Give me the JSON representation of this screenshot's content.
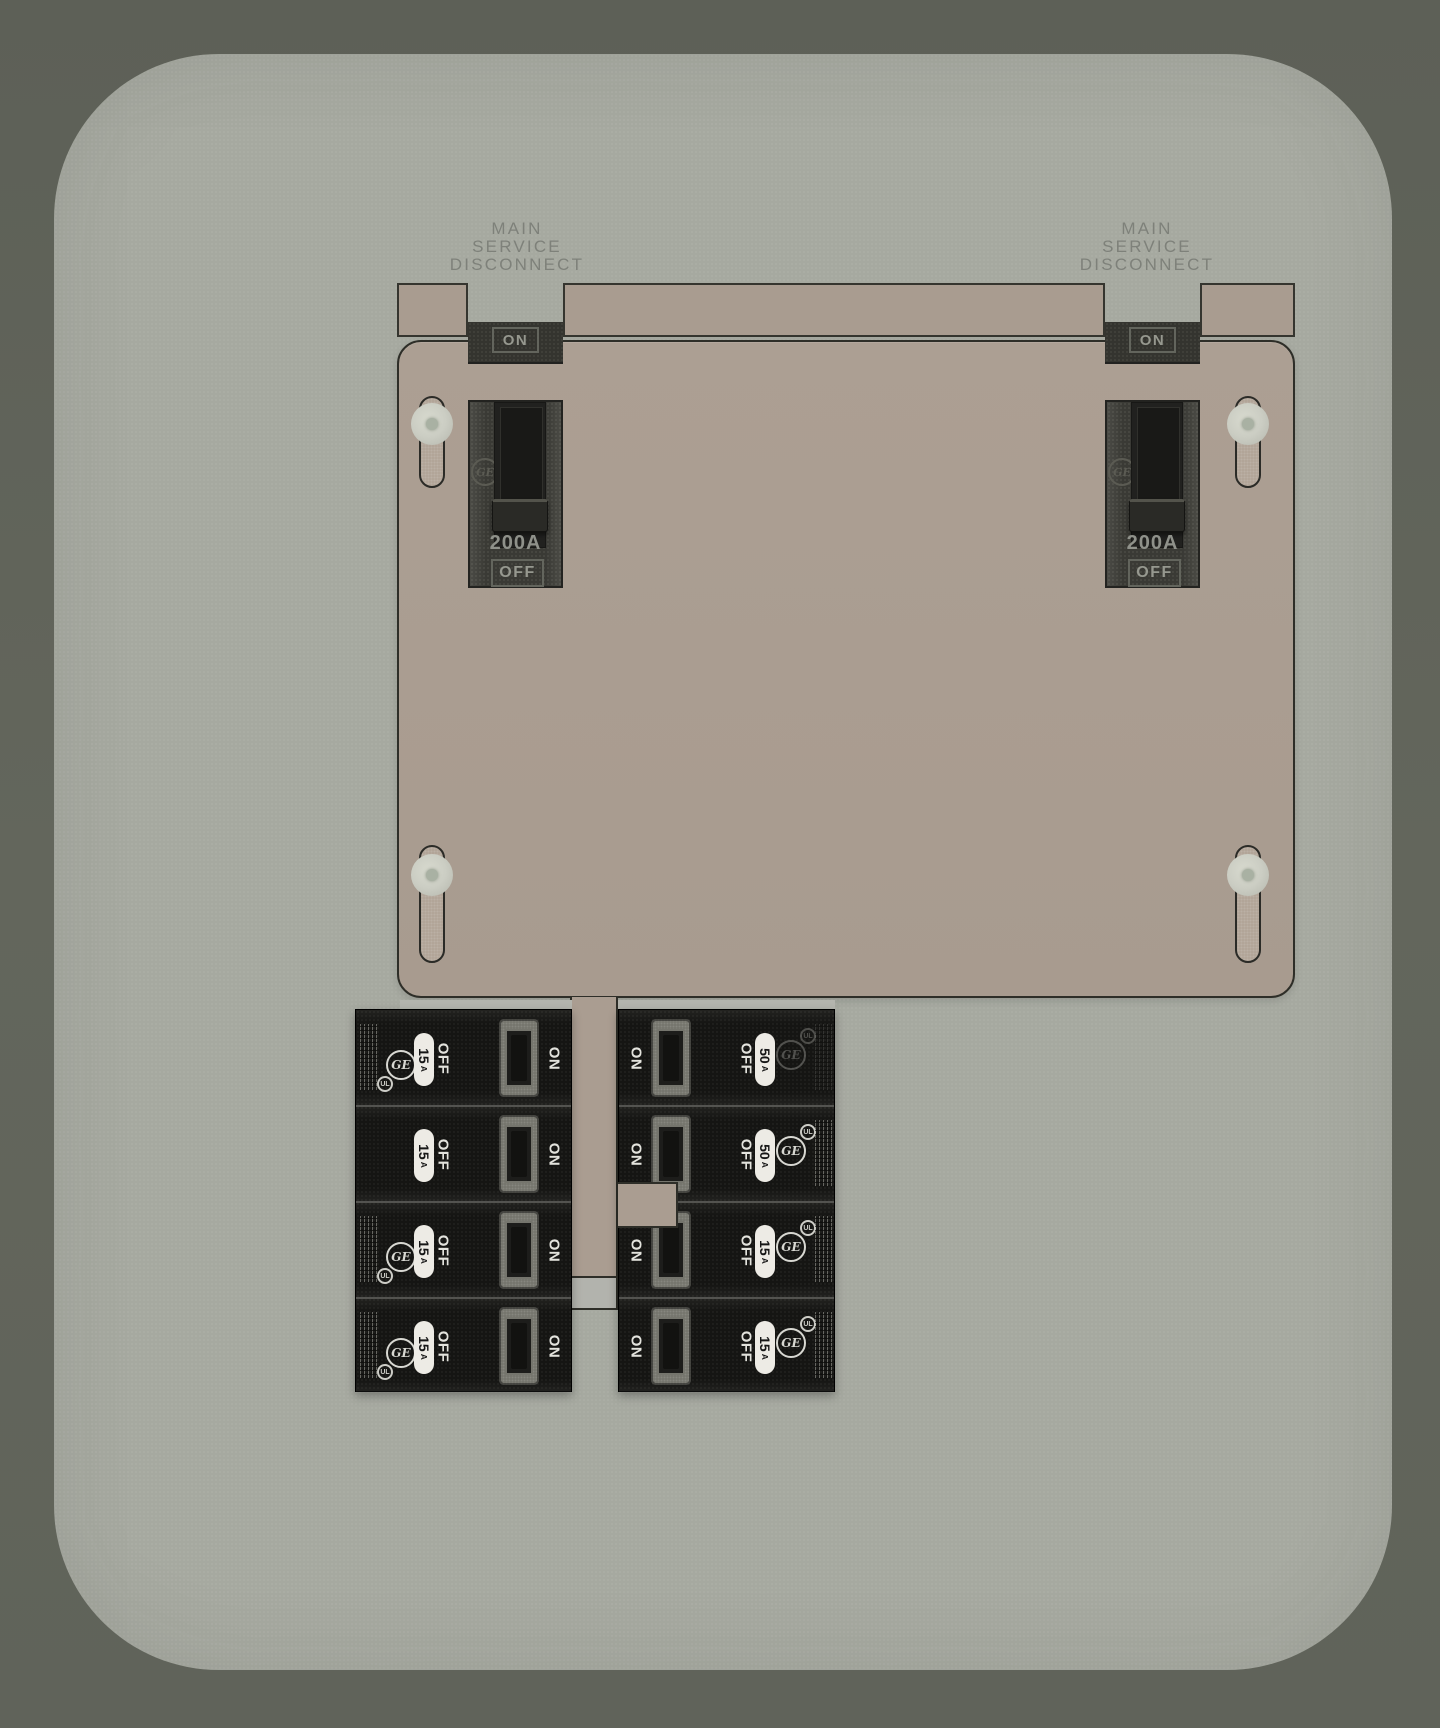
{
  "colors": {
    "background": "#61645a",
    "panel": "#a6a9a0",
    "cover_plate": "#ab9e92",
    "mounting_strip": "#a99c90",
    "outline": "#2e2e28",
    "main_breaker_body": "#3a3a35",
    "branch_breaker_body": "#151513",
    "branch_top_strip": "#b4b5ae",
    "dark_label_text": "#96988f",
    "disconnect_text": "#7e817a",
    "branch_label_text": "#e3e3dd",
    "pill_background": "#edebe5",
    "screw_head": "#cbcdc3"
  },
  "disconnect": {
    "lines": [
      "MAIN",
      "SERVICE",
      "DISCONNECT"
    ]
  },
  "mains": [
    {
      "on": "ON",
      "rating": "200A",
      "off": "OFF",
      "brand": "GE"
    },
    {
      "on": "ON",
      "rating": "200A",
      "off": "OFF",
      "brand": "GE"
    }
  ],
  "branch": {
    "left": {
      "rows": [
        {
          "amp": "15",
          "unit": "A",
          "off": "OFF",
          "on": "ON",
          "brand": "GE",
          "ul": "UL"
        },
        {
          "amp": "15",
          "unit": "A",
          "off": "OFF",
          "on": "ON"
        },
        {
          "amp": "15",
          "unit": "A",
          "off": "OFF",
          "on": "ON",
          "brand": "GE",
          "ul": "UL"
        },
        {
          "amp": "15",
          "unit": "A",
          "off": "OFF",
          "on": "ON",
          "brand": "GE",
          "ul": "UL"
        }
      ]
    },
    "right": {
      "rows": [
        {
          "amp": "50",
          "unit": "A",
          "off": "OFF",
          "on": "ON",
          "brand": "GE",
          "ul": "UL"
        },
        {
          "amp": "50",
          "unit": "A",
          "off": "OFF",
          "on": "ON",
          "brand": "GE",
          "ul": "UL"
        },
        {
          "amp": "15",
          "unit": "A",
          "off": "OFF",
          "on": "ON",
          "brand": "GE",
          "ul": "UL"
        },
        {
          "amp": "15",
          "unit": "A",
          "off": "OFF",
          "on": "ON",
          "brand": "GE",
          "ul": "UL"
        }
      ]
    }
  }
}
